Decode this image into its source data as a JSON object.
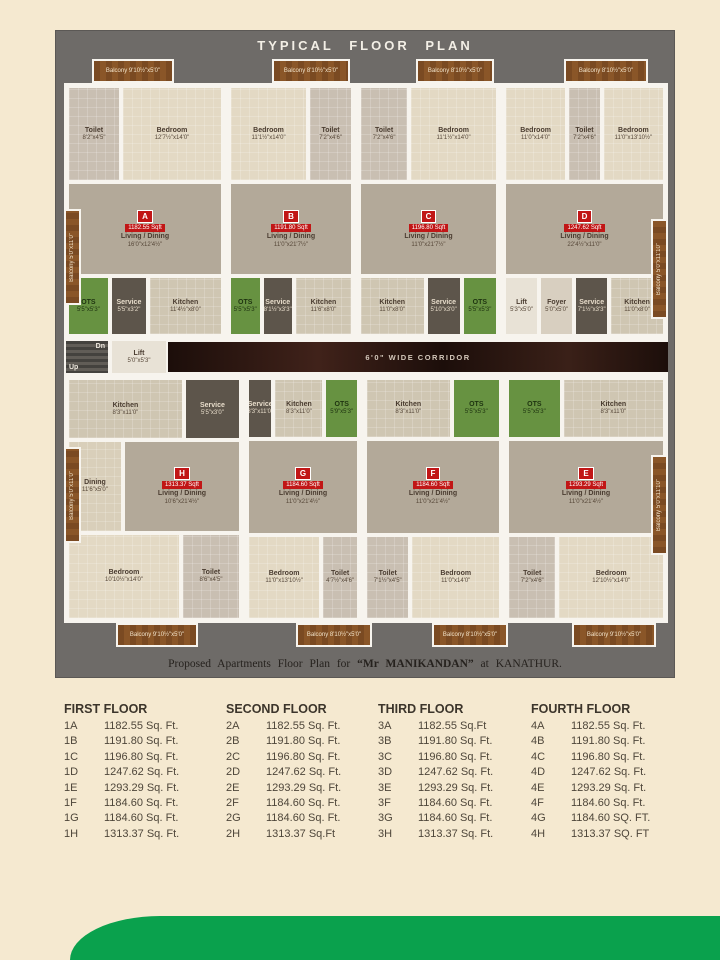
{
  "title": "TYPICAL FLOOR PLAN",
  "caption": {
    "prefix": "Proposed  Apartments  Floor Plan  for",
    "name": "“Mr MANIKANDAN”",
    "connector": "at",
    "location": "KANATHUR."
  },
  "corridor_label": "6'0\" WIDE CORRIDOR",
  "circulation": {
    "stairs_dn": "Dn",
    "stairs_up": "Up",
    "lift_left": {
      "name": "Lift",
      "dim": "5'0\"x5'3\""
    },
    "lift_right": {
      "name": "Lift",
      "dim": "5'3\"x5'0\""
    },
    "foyer": {
      "name": "Foyer",
      "dim": "5'0\"x5'0\""
    }
  },
  "units": {
    "a": {
      "badge": "A",
      "area": "1182.55 Sqft",
      "balcony_top": {
        "name": "Balcony",
        "dim": "9'10½\"x5'0\""
      },
      "balcony_side": {
        "name": "Balcony",
        "dim": "5'0\"x11'0\""
      },
      "toilet": {
        "name": "Toilet",
        "dim": "8'2\"x4'5\""
      },
      "bedroom": {
        "name": "Bedroom",
        "dim": "12'7½\"x14'0\""
      },
      "living": {
        "name": "Living / Dining",
        "dim": "16'0\"x12'4½\""
      },
      "ots": {
        "name": "OTS",
        "dim": "5'5\"x5'3\""
      },
      "service": {
        "name": "Service",
        "dim": "5'5\"x3'2\""
      },
      "kitchen": {
        "name": "Kitchen",
        "dim": "11'4½\"x8'0\""
      }
    },
    "b": {
      "badge": "B",
      "area": "1191.80 Sqft",
      "balcony_top": {
        "name": "Balcony",
        "dim": "8'10½\"x5'0\""
      },
      "bedroom": {
        "name": "Bedroom",
        "dim": "11'1½\"x14'0\""
      },
      "toilet": {
        "name": "Toilet",
        "dim": "7'2\"x4'6\""
      },
      "living": {
        "name": "Living / Dining",
        "dim": "11'0\"x21'7½\""
      },
      "ots": {
        "name": "OTS",
        "dim": "5'5\"x5'3\""
      },
      "service": {
        "name": "Service",
        "dim": "8'1½\"x3'3\""
      },
      "kitchen": {
        "name": "Kitchen",
        "dim": "11'6\"x8'0\""
      }
    },
    "c": {
      "badge": "C",
      "area": "1196.80 Sqft",
      "balcony_top": {
        "name": "Balcony",
        "dim": "8'10½\"x5'0\""
      },
      "bedroom": {
        "name": "Bedroom",
        "dim": "11'1½\"x14'0\""
      },
      "toilet": {
        "name": "Toilet",
        "dim": "7'2\"x4'6\""
      },
      "living": {
        "name": "Living / Dining",
        "dim": "11'0\"x21'7½\""
      },
      "ots": {
        "name": "OTS",
        "dim": "5'5\"x5'3\""
      },
      "service": {
        "name": "Service",
        "dim": "5'10\"x3'0\""
      },
      "kitchen": {
        "name": "Kitchen",
        "dim": "11'0\"x8'0\""
      }
    },
    "d": {
      "badge": "D",
      "area": "1247.62 Sqft",
      "balcony_top": {
        "name": "Balcony",
        "dim": "8'10½\"x5'0\""
      },
      "balcony_side": {
        "name": "Balcony",
        "dim": "5'0\"x11'10\""
      },
      "bedroom": {
        "name": "Bedroom",
        "dim": "11'0\"x14'0\""
      },
      "bedroom2": {
        "name": "Bedroom",
        "dim": "11'0\"x13'10½\""
      },
      "toilet": {
        "name": "Toilet",
        "dim": "7'2\"x4'6\""
      },
      "living": {
        "name": "Living / Dining",
        "dim": "22'4½\"x11'0\""
      },
      "service": {
        "name": "Service",
        "dim": "7'1½\"x3'3\""
      },
      "kitchen": {
        "name": "Kitchen",
        "dim": "11'0\"x8'0\""
      }
    },
    "h": {
      "badge": "H",
      "area": "1313.37 Sqft",
      "balcony_side": {
        "name": "Balcony",
        "dim": "5'0\"x11'0\""
      },
      "balcony_bottom": {
        "name": "Balcony",
        "dim": "9'10½\"x5'0\""
      },
      "kitchen": {
        "name": "Kitchen",
        "dim": "8'3\"x11'0\""
      },
      "service": {
        "name": "Service",
        "dim": "5'5\"x3'0\""
      },
      "dining": {
        "name": "Dining",
        "dim": "11'6\"x5'0\""
      },
      "living": {
        "name": "Living / Dining",
        "dim": "10'6\"x21'4½\""
      },
      "bedroom": {
        "name": "Bedroom",
        "dim": "10'10½\"x14'0\""
      },
      "toilet": {
        "name": "Toilet",
        "dim": "8'6\"x4'5\""
      }
    },
    "g": {
      "badge": "G",
      "area": "1184.60 Sqft",
      "balcony_bottom": {
        "name": "Balcony",
        "dim": "8'10½\"x5'0\""
      },
      "service": {
        "name": "Service",
        "dim": "3'3\"x11'0\""
      },
      "kitchen": {
        "name": "Kitchen",
        "dim": "8'3\"x11'0\""
      },
      "ots": {
        "name": "OTS",
        "dim": "5'9\"x5'3\""
      },
      "living": {
        "name": "Living / Dining",
        "dim": "11'0\"x21'4½\""
      },
      "bedroom": {
        "name": "Bedroom",
        "dim": "11'0\"x13'10½\""
      },
      "toilet": {
        "name": "Toilet",
        "dim": "4'7½\"x4'6\""
      }
    },
    "f": {
      "badge": "F",
      "area": "1184.60 Sqft",
      "balcony_bottom": {
        "name": "Balcony",
        "dim": "8'10½\"x5'0\""
      },
      "kitchen": {
        "name": "Kitchen",
        "dim": "8'3\"x11'0\""
      },
      "ots": {
        "name": "OTS",
        "dim": "5'5\"x5'3\""
      },
      "living": {
        "name": "Living / Dining",
        "dim": "11'0\"x21'4½\""
      },
      "bedroom": {
        "name": "Bedroom",
        "dim": "11'0\"x14'0\""
      },
      "toilet": {
        "name": "Toilet",
        "dim": "7'1½\"x4'5\""
      }
    },
    "e": {
      "badge": "E",
      "area": "1293.29 Sqft",
      "balcony_side": {
        "name": "Balcony",
        "dim": "5'0\"x11'10\""
      },
      "balcony_bottom": {
        "name": "Balcony",
        "dim": "9'10½\"x5'0\""
      },
      "kitchen": {
        "name": "Kitchen",
        "dim": "8'3\"x11'0\""
      },
      "ots": {
        "name": "OTS",
        "dim": "5'5\"x5'3\""
      },
      "living": {
        "name": "Living / Dining",
        "dim": "11'0\"x21'4½\""
      },
      "bedroom": {
        "name": "Bedroom",
        "dim": "12'10½\"x14'0\""
      },
      "toilet": {
        "name": "Toilet",
        "dim": "7'2\"x4'6\""
      }
    }
  },
  "floors": [
    {
      "title": "FIRST FLOOR",
      "rows": [
        [
          "1A",
          "1182.55 Sq. Ft."
        ],
        [
          "1B",
          "1191.80 Sq. Ft."
        ],
        [
          "1C",
          "1196.80 Sq. Ft."
        ],
        [
          "1D",
          "1247.62 Sq. Ft."
        ],
        [
          "1E",
          "1293.29 Sq. Ft."
        ],
        [
          "1F",
          "1184.60 Sq. Ft."
        ],
        [
          "1G",
          "1184.60 Sq. Ft."
        ],
        [
          "1H",
          "1313.37 Sq. Ft."
        ]
      ]
    },
    {
      "title": "SECOND FLOOR",
      "rows": [
        [
          "2A",
          "1182.55 Sq. Ft."
        ],
        [
          "2B",
          "1191.80 Sq. Ft."
        ],
        [
          "2C",
          "1196.80 Sq. Ft."
        ],
        [
          "2D",
          "1247.62 Sq. Ft."
        ],
        [
          "2E",
          "1293.29 Sq. Ft."
        ],
        [
          "2F",
          "1184.60 Sq. Ft."
        ],
        [
          "2G",
          "1184.60 Sq. Ft."
        ],
        [
          "2H",
          "1313.37 Sq.Ft"
        ]
      ]
    },
    {
      "title": "THIRD FLOOR",
      "rows": [
        [
          "3A",
          "1182.55 Sq.Ft"
        ],
        [
          "3B",
          "1191.80 Sq. Ft."
        ],
        [
          "3C",
          "1196.80 Sq. Ft."
        ],
        [
          "3D",
          "1247.62 Sq. Ft."
        ],
        [
          "3E",
          "1293.29 Sq. Ft."
        ],
        [
          "3F",
          "1184.60 Sq. Ft."
        ],
        [
          "3G",
          "1184.60 Sq. Ft."
        ],
        [
          "3H",
          "1313.37 Sq. Ft."
        ]
      ]
    },
    {
      "title": "FOURTH FLOOR",
      "rows": [
        [
          "4A",
          "1182.55 Sq. Ft."
        ],
        [
          "4B",
          "1191.80 Sq. Ft."
        ],
        [
          "4C",
          "1196.80 Sq. Ft."
        ],
        [
          "4D",
          "1247.62 Sq. Ft."
        ],
        [
          "4E",
          "1293.29 Sq. Ft."
        ],
        [
          "4F",
          "1184.60 Sq. Ft."
        ],
        [
          "4G",
          "1184.60 SQ. FT."
        ],
        [
          "4H",
          "1313.37 SQ. FT"
        ]
      ]
    }
  ],
  "colors": {
    "page_bg": "#f5e9d0",
    "plan_bg": "#6e6b68",
    "accent_green": "#0aa14d",
    "badge_red": "#c11616",
    "balcony_brown": "#7a4a22",
    "ots_green": "#679241",
    "corridor_dark": "#241310"
  }
}
